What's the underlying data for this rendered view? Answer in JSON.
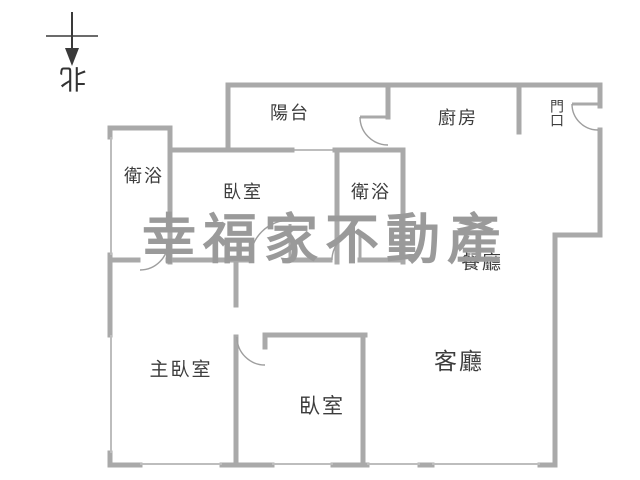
{
  "compass": {
    "north_label": "北"
  },
  "watermark": {
    "text": "幸福家不動產",
    "color": "#9a9a9a"
  },
  "rooms": [
    {
      "id": "balcony",
      "label": "陽台"
    },
    {
      "id": "kitchen",
      "label": "廚房"
    },
    {
      "id": "entrance",
      "label": "門口"
    },
    {
      "id": "bathroom-1",
      "label": "衛浴"
    },
    {
      "id": "bedroom-1",
      "label": "臥室"
    },
    {
      "id": "bathroom-2",
      "label": "衛浴"
    },
    {
      "id": "dining-room",
      "label": "餐廳"
    },
    {
      "id": "master-bedroom",
      "label": "主臥室"
    },
    {
      "id": "bedroom-2",
      "label": "臥室"
    },
    {
      "id": "living-room",
      "label": "客廳"
    }
  ],
  "colors": {
    "background": "#ffffff",
    "wall": "#a9a9a9",
    "window": "#bdbdbd",
    "door_arc": "#9e9e9e",
    "text": "#3d3d3d",
    "compass": "#3a3a3a",
    "watermark": "#9a9a9a"
  }
}
